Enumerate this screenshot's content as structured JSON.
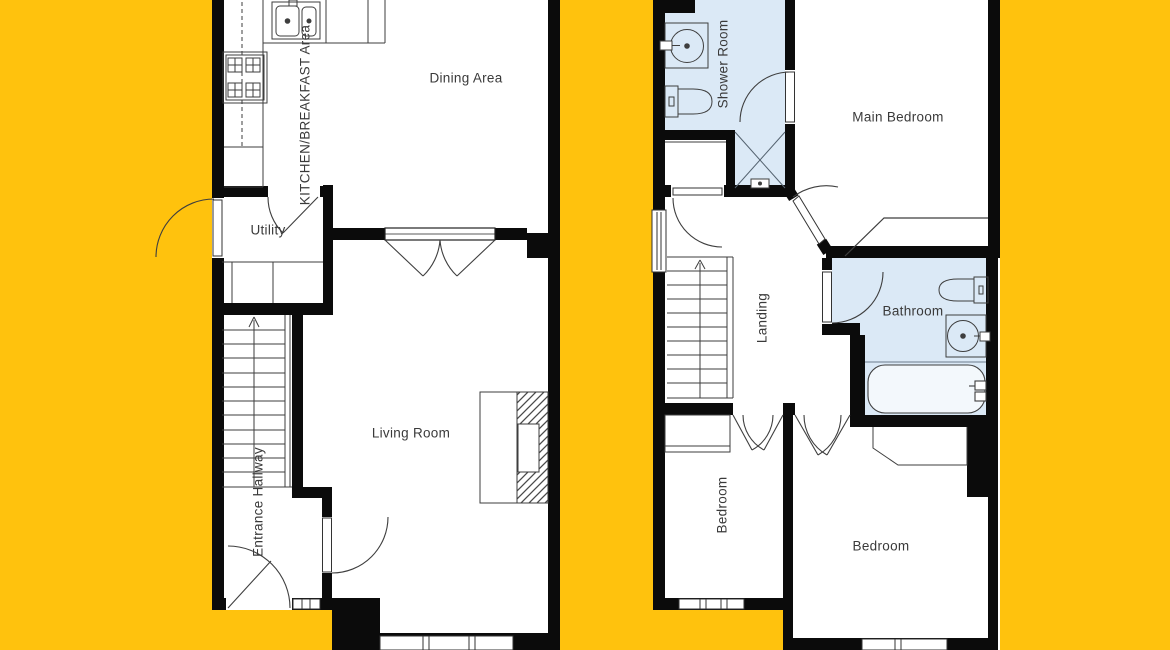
{
  "image_type": "floor-plan",
  "colors": {
    "background_yellow": "#FFC20D",
    "wall_black": "#0B0B0B",
    "room_white": "#FFFFFF",
    "wet_room_blue": "#DBE9F6",
    "line_gray": "#3E3E3E",
    "label_text": "#3A3A3A"
  },
  "ground_floor": {
    "rooms": [
      {
        "label": "Dining Area",
        "orientation": "horizontal"
      },
      {
        "label": "KITCHEN/BREAKFAST Area",
        "orientation": "vertical"
      },
      {
        "label": "Utility",
        "orientation": "horizontal"
      },
      {
        "label": "Living Room",
        "orientation": "horizontal"
      },
      {
        "label": "Entrance Hallway",
        "orientation": "vertical"
      }
    ],
    "features": [
      "staircase-up",
      "fireplace",
      "kitchen-sink",
      "hob",
      "french-doors",
      "front-door",
      "bay-window"
    ]
  },
  "first_floor": {
    "rooms": [
      {
        "label": "Shower Room",
        "orientation": "vertical"
      },
      {
        "label": "Main Bedroom",
        "orientation": "horizontal"
      },
      {
        "label": "Landing",
        "orientation": "vertical"
      },
      {
        "label": "Bathroom",
        "orientation": "horizontal"
      },
      {
        "label": "Bedroom",
        "orientation": "vertical"
      },
      {
        "label": "Bedroom",
        "orientation": "horizontal"
      }
    ],
    "features": [
      "staircase-up",
      "shower-cubicle",
      "toilet",
      "basin",
      "bathtub",
      "wardrobes",
      "windows"
    ]
  }
}
